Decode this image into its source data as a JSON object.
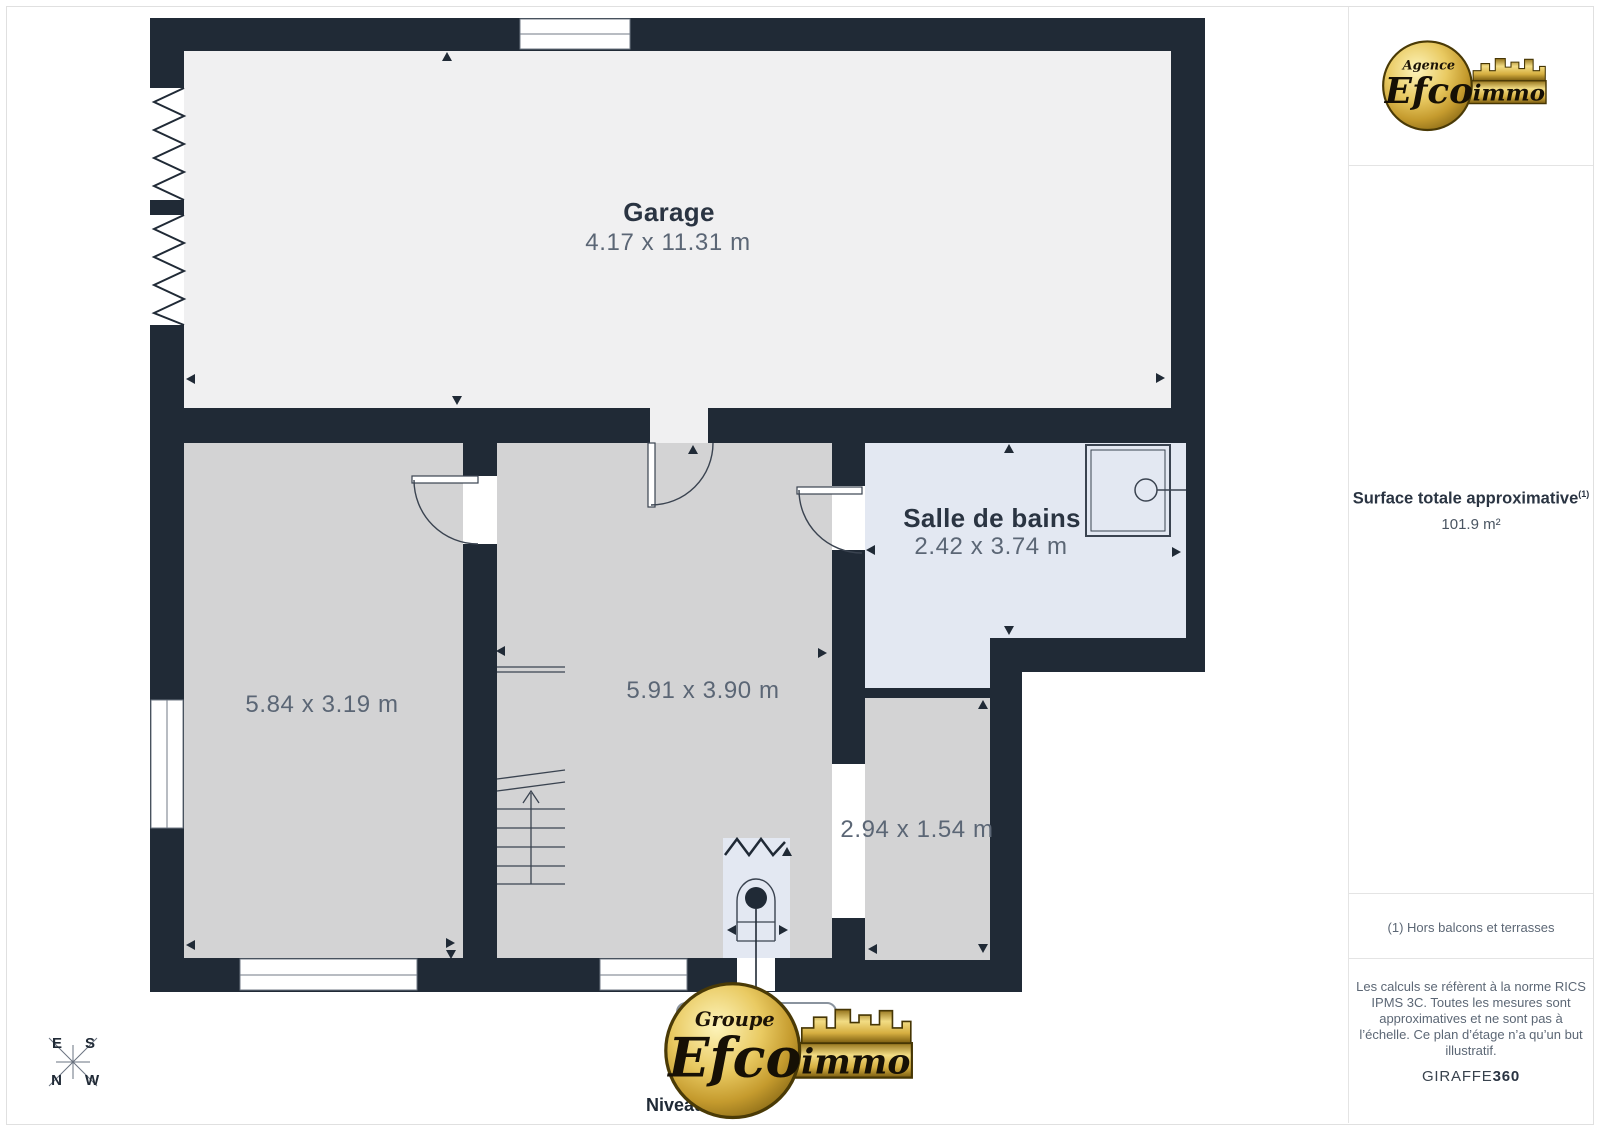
{
  "page": {
    "background": "#ffffff",
    "wall_color": "#202a36",
    "accent_gold": "#d8b14a"
  },
  "floorplan": {
    "level_label": "Niveau 0",
    "rooms": [
      {
        "name": "Garage",
        "dimensions": "4.17 x 11.31 m"
      },
      {
        "name": "",
        "dimensions": "5.84 x 3.19 m"
      },
      {
        "name": "",
        "dimensions": "5.91 x 3.90 m"
      },
      {
        "name": "Salle de bains",
        "dimensions": "2.42 x 3.74 m"
      },
      {
        "name": "",
        "dimensions": "2.94 x 1.54 m"
      }
    ],
    "compass": {
      "north": "N",
      "south": "S",
      "east": "E",
      "west": "W"
    }
  },
  "footer_logo": {
    "tagline": "Groupe",
    "brand": "Efco",
    "suffix": "immo"
  },
  "sidebar": {
    "logo": {
      "tagline": "Agence",
      "brand": "Efco",
      "suffix": "immo"
    },
    "surface": {
      "label": "Surface totale approximative",
      "footnote_marker": "(1)",
      "value": "101.9 m²"
    },
    "footnote": "(1) Hors balcons et terrasses",
    "disclaimer": "Les calculs se réfèrent à la norme RICS IPMS 3C. Toutes les mesures sont approximatives et ne sont pas à l’échelle. Ce plan d’étage n’a qu’un but illustratif.",
    "engine": {
      "name": "GIRAFFE",
      "bold": "360"
    }
  }
}
